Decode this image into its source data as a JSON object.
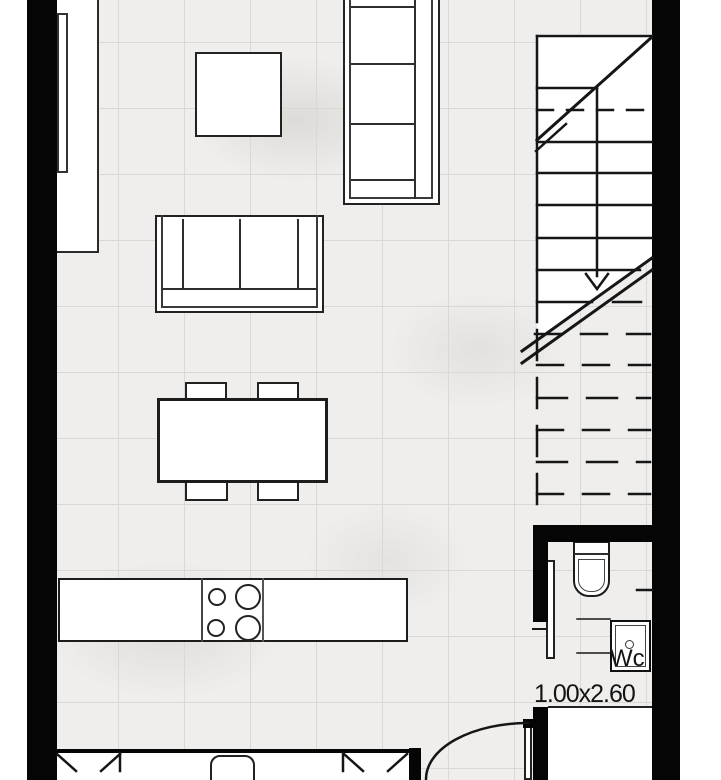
{
  "floorplan": {
    "wc_room": {
      "label": "Wc",
      "dimensions": "1.00x2.60"
    },
    "colors": {
      "wall": "#050505",
      "drawing_line": "#161616",
      "floor_tile": "#efeeec",
      "tile_grid": "#d9d8d5",
      "fill_white": "#ffffff"
    },
    "rooms": [
      {
        "name": "living-dining-kitchen"
      },
      {
        "name": "staircase"
      },
      {
        "name": "wc"
      }
    ],
    "furniture": [
      "tv-sideboard",
      "tv",
      "coffee-table",
      "sofa-vertical",
      "sofa-horizontal",
      "dining-table",
      "dining-chair-x4",
      "kitchen-counter",
      "cooktop-4-burners",
      "toilet",
      "sink",
      "entry-door-swing",
      "wc-door-leaf",
      "window-panels",
      "stair-run-with-break-line"
    ]
  }
}
